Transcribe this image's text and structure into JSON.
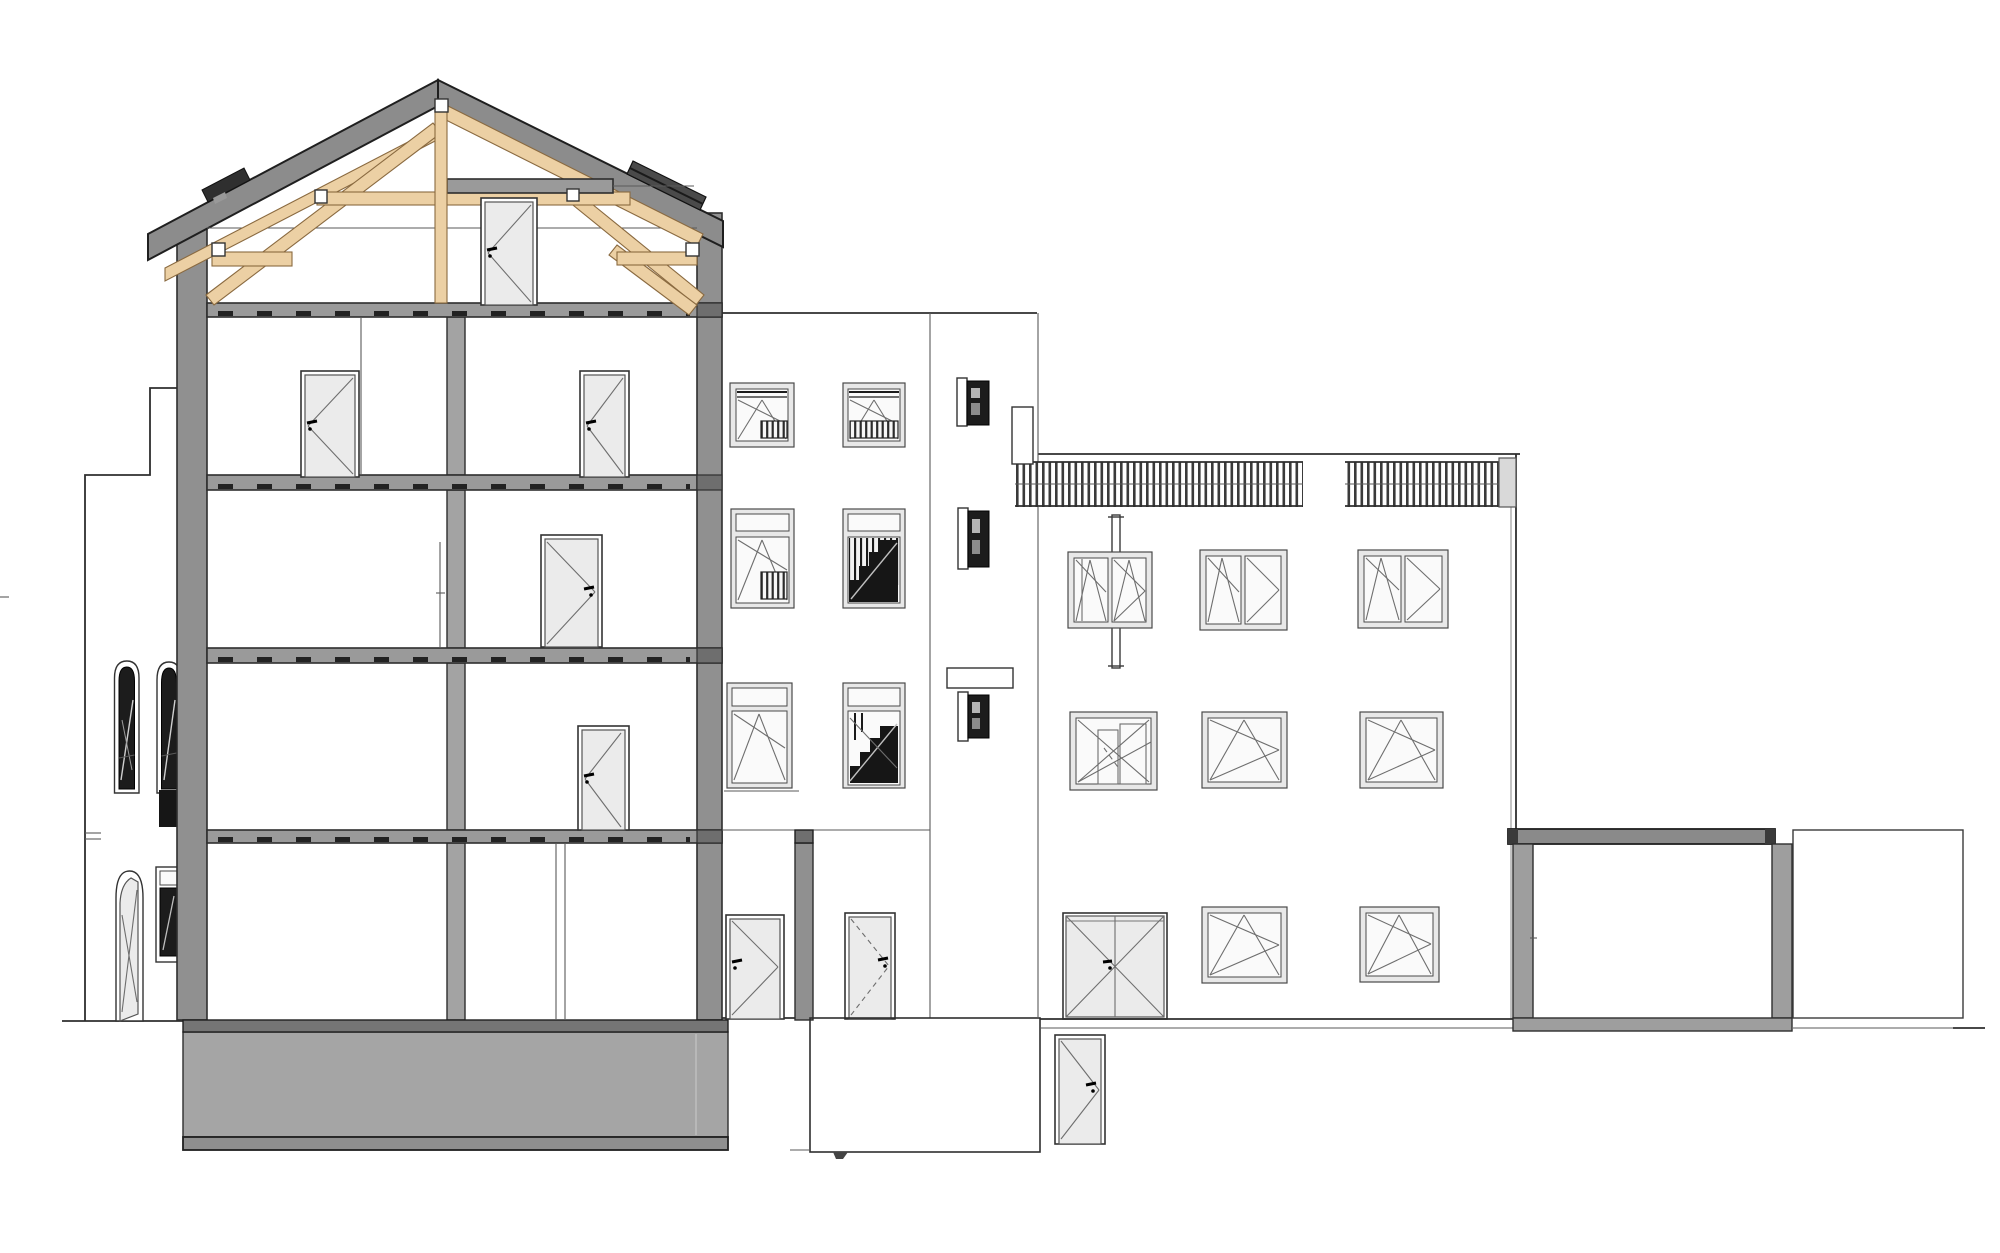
{
  "drawing": {
    "kind": "architectural longitudinal section and elevation",
    "text_labels": [],
    "palette": {
      "paper": "#ffffff",
      "line_dark": "#2e2e2e",
      "line_mid": "#5a5a5a",
      "wall_gray": "#909090",
      "slab_gray": "#9a9a9a",
      "slab_dark": "#6e6e6e",
      "roof_gray": "#8c8c8c",
      "foundation_top": "#757575",
      "foundation_body": "#a5a5a5",
      "foundation_base": "#8f8f8f",
      "wood_tan": "#ecd0a4",
      "wood_edge": "#8a6a40",
      "door_leaf": "#ebebeb",
      "frame_light": "#e8e8e8",
      "glass_white": "#fafafa",
      "glazing_dark": "#1c1c1c",
      "bar_dark": "#3a3a3a"
    },
    "inventory": {
      "buildings": 5,
      "section_building": {
        "floors": 4,
        "attic_with_timber_truss": true,
        "roof": "gable",
        "interior_doors": 5,
        "skylights": 2,
        "foundation_block": true
      },
      "left_annex": {
        "arched_windows": 2,
        "narrow_windows": 1,
        "arched_door": 1
      },
      "middle_stair_building": {
        "windows": 6,
        "stair_windows": 2,
        "slit_windows": 3,
        "ground_doors": 2
      },
      "right_building": {
        "terrace_railing": true,
        "chimney": 1,
        "upper_windows": 3,
        "middle_windows": 3,
        "ground_windows": 2,
        "garage_door": 1,
        "basement_door": 1,
        "downpipe": 1
      },
      "rear_annex": {
        "cut_walls": 2,
        "outline_building": 1
      }
    }
  }
}
